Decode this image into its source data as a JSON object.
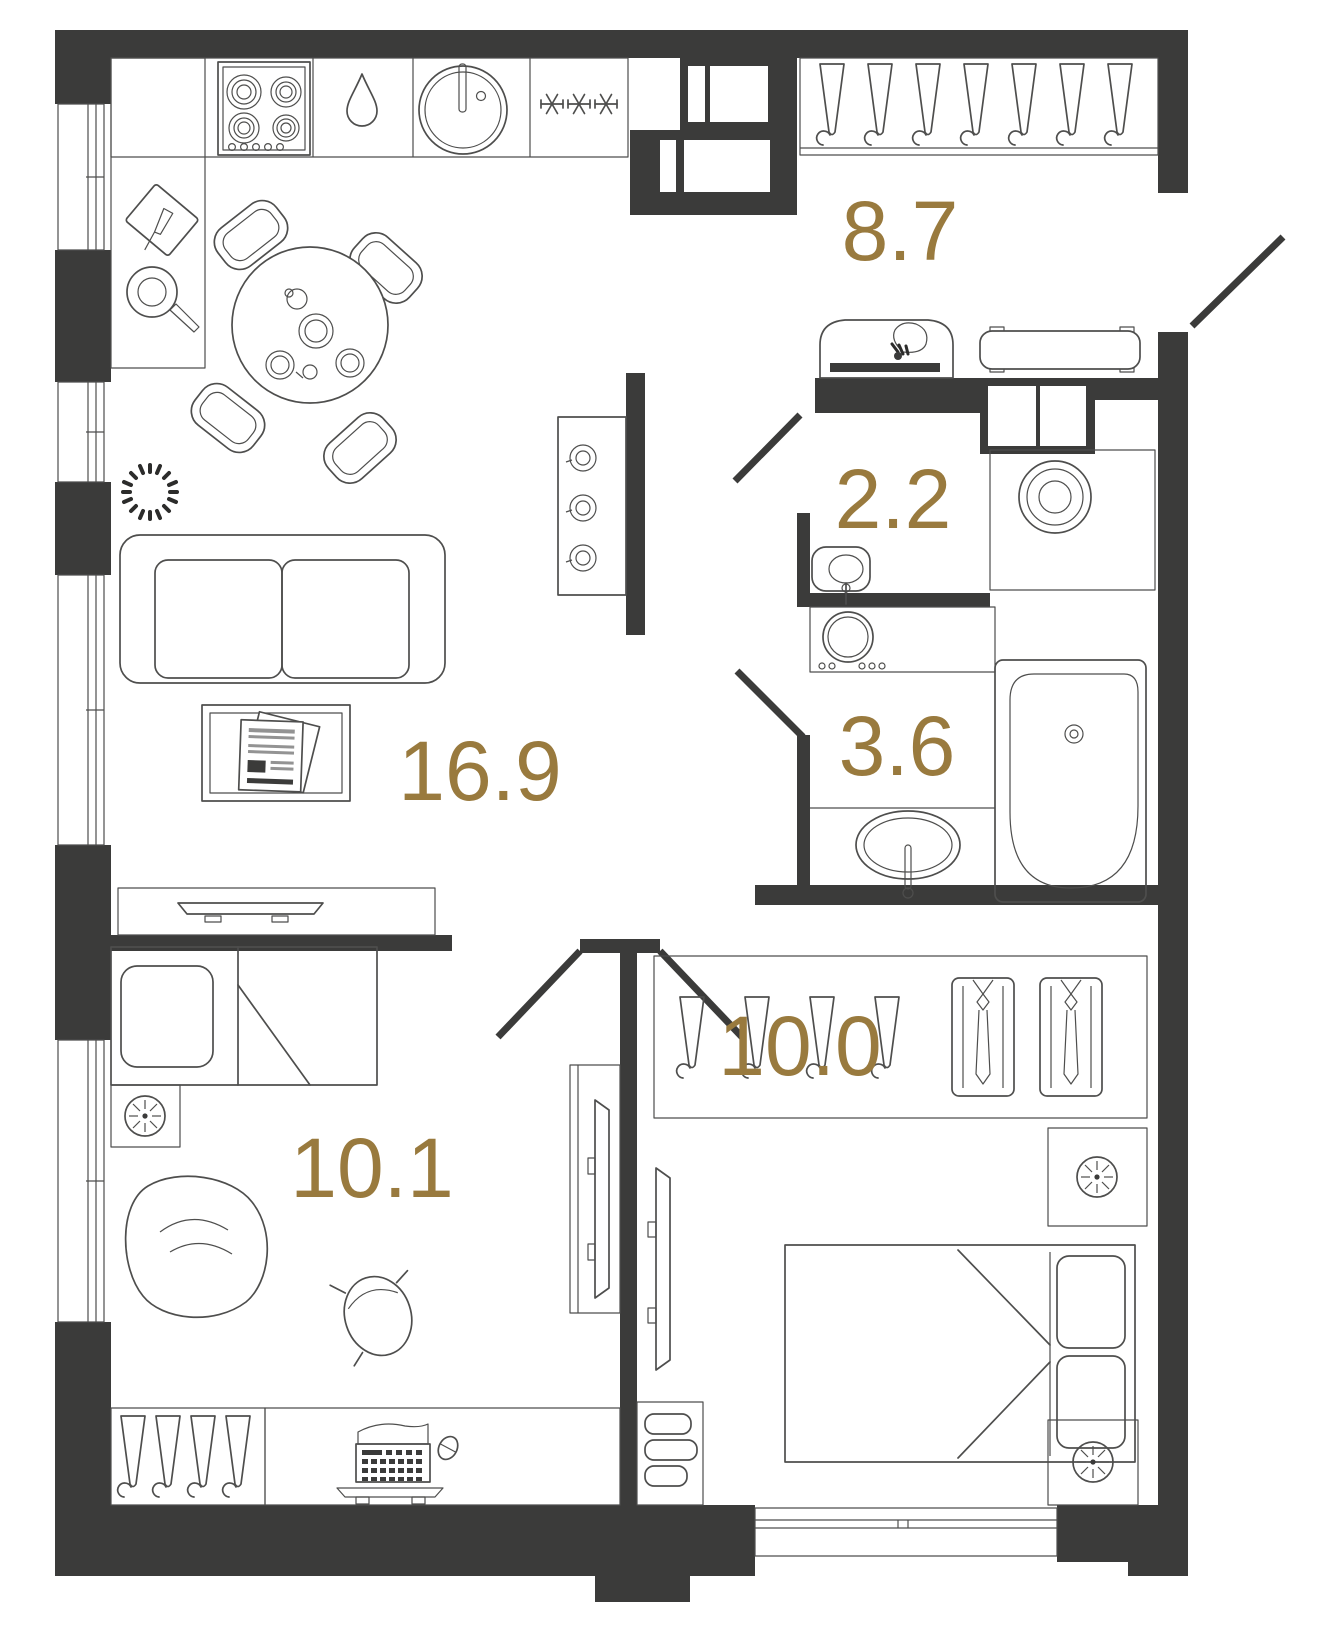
{
  "plan": {
    "type": "apartment-floor-plan",
    "rooms": [
      {
        "id": "kitchen-living",
        "area_label": "16.9"
      },
      {
        "id": "hallway",
        "area_label": "8.7"
      },
      {
        "id": "wc",
        "area_label": "2.2"
      },
      {
        "id": "bathroom",
        "area_label": "3.6"
      },
      {
        "id": "bedroom",
        "area_label": "10.0"
      },
      {
        "id": "kids-room",
        "area_label": "10.1"
      }
    ],
    "colors": {
      "walls": "#3b3b3a",
      "furniture_stroke": "#4e4e4d",
      "area_label": "#997a3e",
      "background": "#ffffff"
    },
    "icons": [
      "hob",
      "drop",
      "round-sink",
      "snowflakes",
      "cutting-board",
      "frying-pan",
      "dining-table",
      "chair",
      "sofa",
      "coffee-table",
      "newspaper",
      "plant",
      "tv",
      "media-shelf",
      "hanger",
      "shirt",
      "console-lamp",
      "bench",
      "entrance-door",
      "toilet",
      "water-heater",
      "duct-shaft",
      "washing-machine",
      "bathtub",
      "oval-sink",
      "single-bed",
      "double-bed",
      "pillow",
      "bedside-table",
      "bean-bag",
      "desk",
      "laptop",
      "mouse",
      "desk-chair",
      "drawer-unit",
      "window"
    ]
  }
}
